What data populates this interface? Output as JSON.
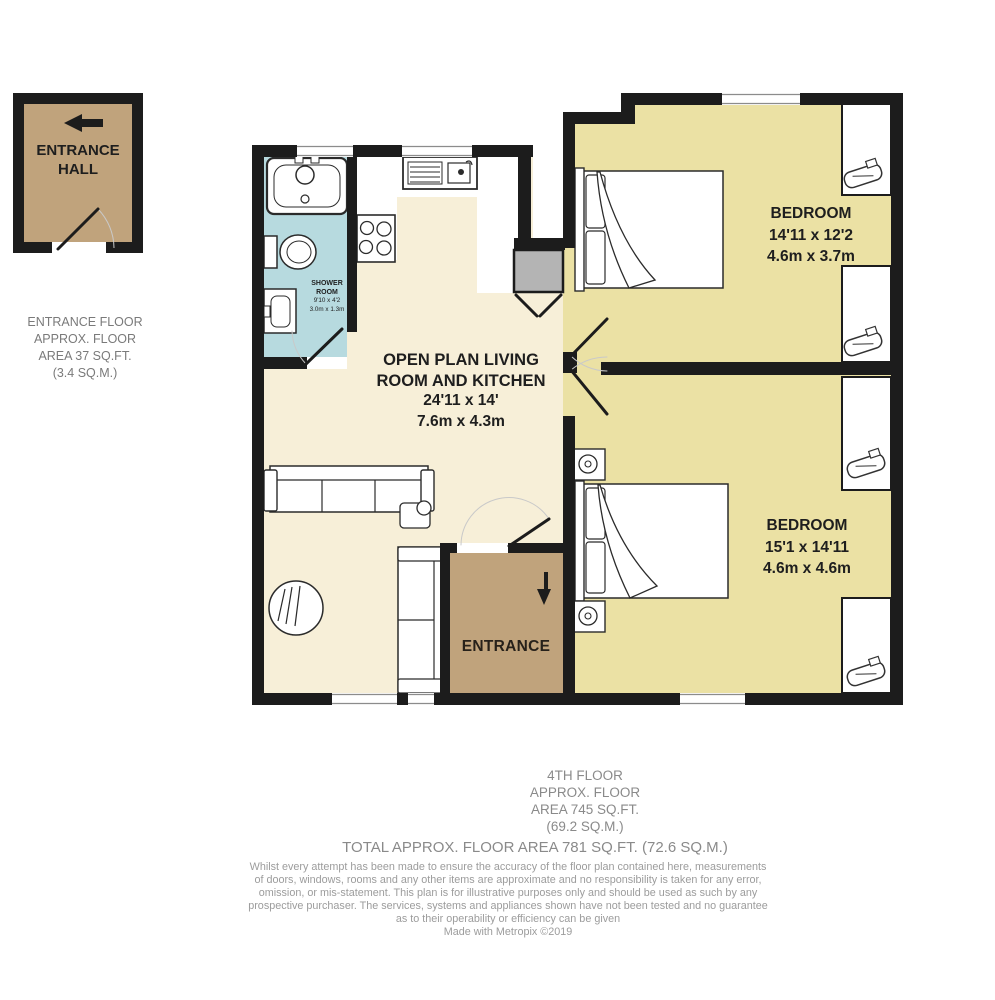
{
  "colors": {
    "wall_black": "#1c1c1c",
    "living_cream": "#f7efd8",
    "bedroom_yellow": "#ebe1a4",
    "shower_blue": "#b7dadf",
    "entrance_brown": "#c0a37c",
    "duct_gray": "#b4b4b4"
  },
  "entrance_hall": {
    "label_line1": "ENTRANCE",
    "label_line2": "HALL"
  },
  "entrance_floor_note": {
    "lines": [
      "ENTRANCE FLOOR",
      "APPROX. FLOOR",
      "AREA 37 SQ.FT.",
      "(3.4 SQ.M.)"
    ]
  },
  "shower_room": {
    "name_line1": "SHOWER",
    "name_line2": "ROOM",
    "dims_imperial": "9'10 x 4'2",
    "dims_metric": "3.0m x 1.3m"
  },
  "living_room": {
    "name_line1": "OPEN PLAN LIVING",
    "name_line2": "ROOM AND KITCHEN",
    "dims_imperial": "24'11 x 14'",
    "dims_metric": "7.6m x 4.3m"
  },
  "bedroom_top": {
    "name": "BEDROOM",
    "dims_imperial": "14'11 x 12'2",
    "dims_metric": "4.6m x 3.7m"
  },
  "bedroom_bottom": {
    "name": "BEDROOM",
    "dims_imperial": "15'1 x 14'11",
    "dims_metric": "4.6m x 4.6m"
  },
  "entrance": {
    "label": "ENTRANCE"
  },
  "footer": {
    "floor_summary_lines": [
      "4TH FLOOR",
      "APPROX. FLOOR",
      "AREA 745 SQ.FT.",
      "(69.2 SQ.M.)"
    ],
    "total_line": "TOTAL APPROX. FLOOR AREA 781 SQ.FT. (72.6 SQ.M.)",
    "disclaimer_lines": [
      "Whilst every attempt has been made to ensure the accuracy of the floor plan contained here, measurements",
      "of doors, windows, rooms and any other items are approximate and no responsibility is taken for any error,",
      "omission, or mis-statement. This plan is for illustrative purposes only and should be used as such by any",
      "prospective purchaser. The services, systems and appliances shown have not been tested and no guarantee",
      "as to their operability or efficiency can be given",
      "Made with Metropix ©2019"
    ]
  }
}
